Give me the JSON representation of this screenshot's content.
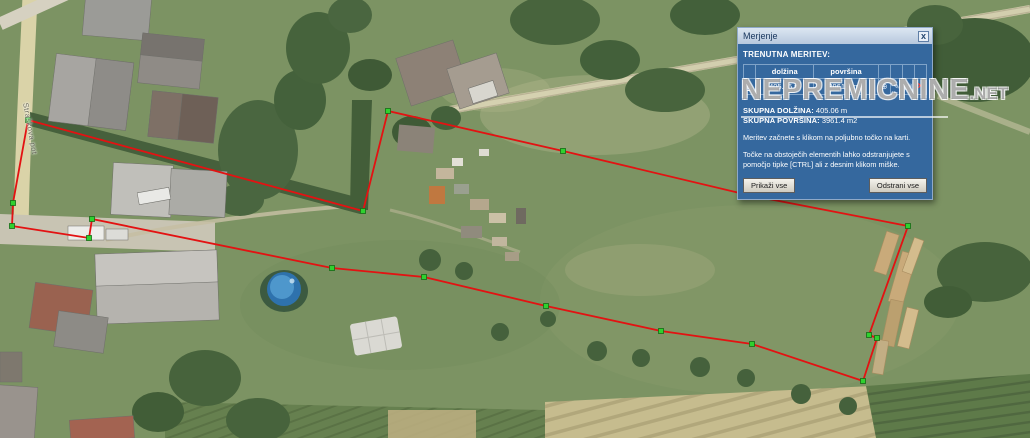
{
  "map": {
    "street_label": "Straškova pot"
  },
  "watermark": {
    "text": "NEPREMICNINE",
    "suffix": ".NET"
  },
  "measurement": {
    "line_color": "#E31212",
    "vertex_color": "#2FD12F",
    "vertex_border": "#156b15",
    "polygon_points": "28,120 363,211 388,111 563,151 748,195 908,226 869,335 877,338 863,381 752,344 661,331 546,306 424,277 332,268 92,219 89,238 12,226 13,203",
    "vertices": [
      [
        28,
        120
      ],
      [
        363,
        211
      ],
      [
        388,
        111
      ],
      [
        563,
        151
      ],
      [
        748,
        195
      ],
      [
        908,
        226
      ],
      [
        869,
        335
      ],
      [
        877,
        338
      ],
      [
        863,
        381
      ],
      [
        752,
        344
      ],
      [
        661,
        331
      ],
      [
        546,
        306
      ],
      [
        424,
        277
      ],
      [
        332,
        268
      ],
      [
        92,
        219
      ],
      [
        89,
        238
      ],
      [
        12,
        226
      ],
      [
        13,
        203
      ]
    ]
  },
  "panel": {
    "title": "Merjenje",
    "close_label": "x",
    "section_title": "TRENUTNA MERITEV:",
    "table": {
      "num_header": "",
      "dolzina_header": "dolžina",
      "povrsina_header": "površina",
      "rows": [
        {
          "num": "1",
          "dolzina": "405.06 m",
          "povrsina": "3961.4 m2",
          "icons": [
            "zoom-to-icon",
            "edit-icon",
            "details-icon",
            "delete-icon"
          ]
        }
      ]
    },
    "totals": {
      "length_label": "SKUPNA DOLŽINA:",
      "length_value": "405.06 m",
      "area_label": "SKUPNA POVRŠINA:",
      "area_value": "3961.4 m2"
    },
    "help1": "Meritev začnete s klikom na poljubno točko na karti.",
    "help2": "Točke na obstoječih elementih lahko odstranjujete s pomočjo tipke [CTRL] ali z desnim klikom miške.",
    "buttons": {
      "show_all": "Prikaži vse",
      "remove_all": "Odstrani vse"
    }
  }
}
